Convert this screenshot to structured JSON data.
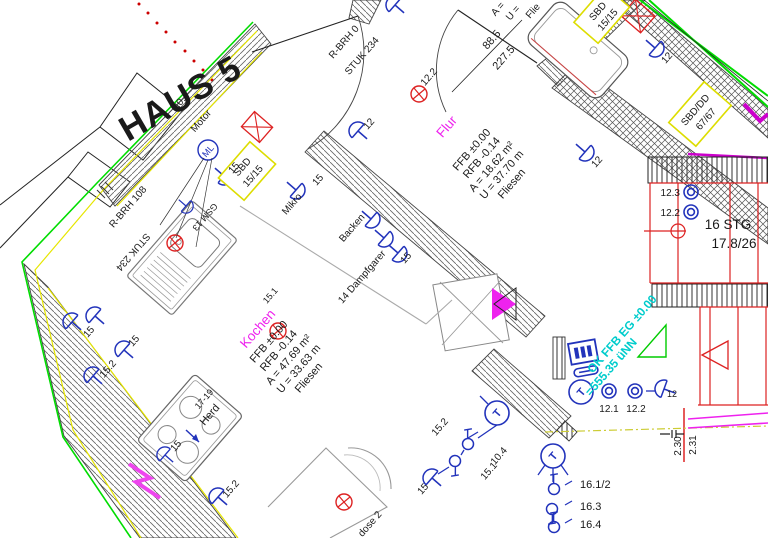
{
  "title": {
    "text": "HAUS 5"
  },
  "rooms": {
    "kochen": {
      "name": "Kochen",
      "ref": "15.1",
      "ffb": "FFB ±0.00",
      "rfb": "RFB -0.14",
      "area": "A = 47.69 m²",
      "perimeter": "U = 33.63 m",
      "floor": "Fliesen"
    },
    "flur": {
      "name": "Flur",
      "ref": "12.2",
      "ffb": "FFB ±0.00",
      "rfb": "RFB -0.14",
      "area": "A = 18.62 m²",
      "perimeter": "U = 37.70 m",
      "floor": "Fliesen"
    },
    "bad": {
      "area_partial": "A =",
      "perimeter_partial": "U =",
      "floor_partial": "Flie"
    }
  },
  "stairs": {
    "steps": "16 STG",
    "rise_run": "17.8/26",
    "dim1": "2.30",
    "dim2": "2.31"
  },
  "level_marks": {
    "line1": "OK FFB EG ±0.00",
    "line2": "=555.35 üNN"
  },
  "doors": {
    "flur_door": {
      "label1": "R-BRH 0",
      "label2": "STUK 234"
    },
    "kitchen_window": {
      "label1": "R-BRH 108",
      "label2": "STUK 234"
    },
    "bath_door": {
      "width": "88.5",
      "height": "227.5"
    }
  },
  "boxes": {
    "sbd_kitchen": {
      "line1": "SBD",
      "line2": "15/15"
    },
    "sbd_bath": {
      "line1": "SBD",
      "line2": "15/15"
    },
    "sbd_stairs": {
      "line1": "SBD/DD",
      "line2": "67/67"
    }
  },
  "appliances": {
    "motor": "Motor",
    "motor_symbol": "ML",
    "motor_dim": "10.4",
    "mikro": "Mikro",
    "backen": "Backen",
    "dampfgarer": "14 Dampfgarer",
    "herd": "Herd",
    "herd_ref": "17-19",
    "sink_ref": "GSM 13",
    "floor_socket": "dose 2"
  },
  "circuits": {
    "c15": "15",
    "c15_1": "15.1",
    "c15_2": "15.2",
    "c10_4": "10.4",
    "c12": "12",
    "c12_1": "12.1",
    "c12_2": "12.2",
    "c12_3": "12.3",
    "c16_12": "16.1/2",
    "c16_3": "16.3",
    "c16_4": "16.4",
    "t": "T"
  },
  "colors": {
    "wall_green": "#00dd00",
    "face_yellow": "#e6e600",
    "stair_red": "#dd2222",
    "symbol_blue": "#2233bb",
    "room_magenta": "#ee22ee",
    "level_cyan": "#00cccc"
  }
}
